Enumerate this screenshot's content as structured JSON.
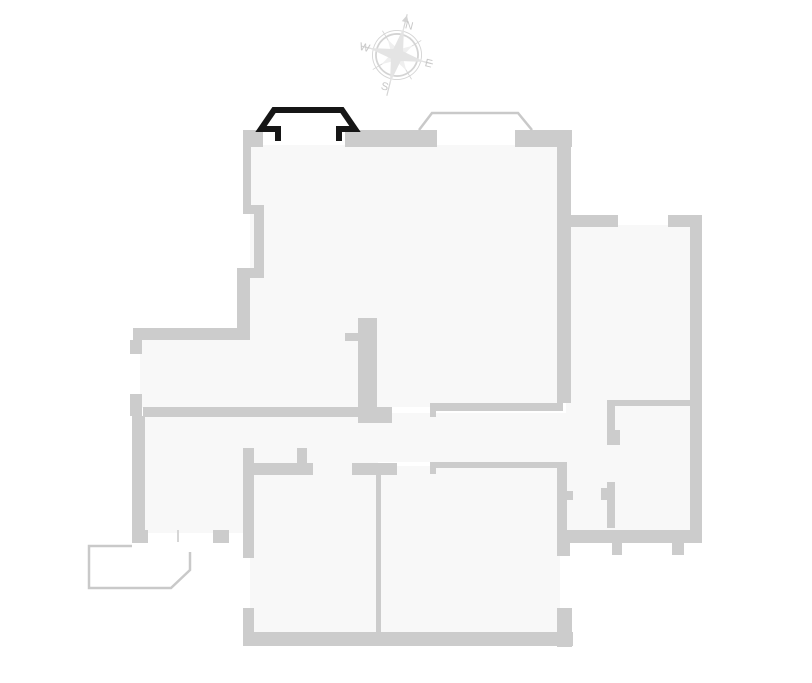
{
  "floorplan": {
    "wall_color": "#cccccc",
    "room_fill": "#f8f8f8",
    "outline_color": "#c9c9c9",
    "thin_line_color": "#d6d6d6",
    "selected_color": "#161616",
    "selected_element": "bay-window-top-left"
  },
  "compass": {
    "ring_color": "#d4d4d4",
    "star_fill": "#e4e4e4",
    "inner_star_fill": "#efefef",
    "label_color": "#c8c8c8",
    "labels": {
      "north": "N",
      "east": "E",
      "south": "S",
      "west": "W"
    }
  }
}
